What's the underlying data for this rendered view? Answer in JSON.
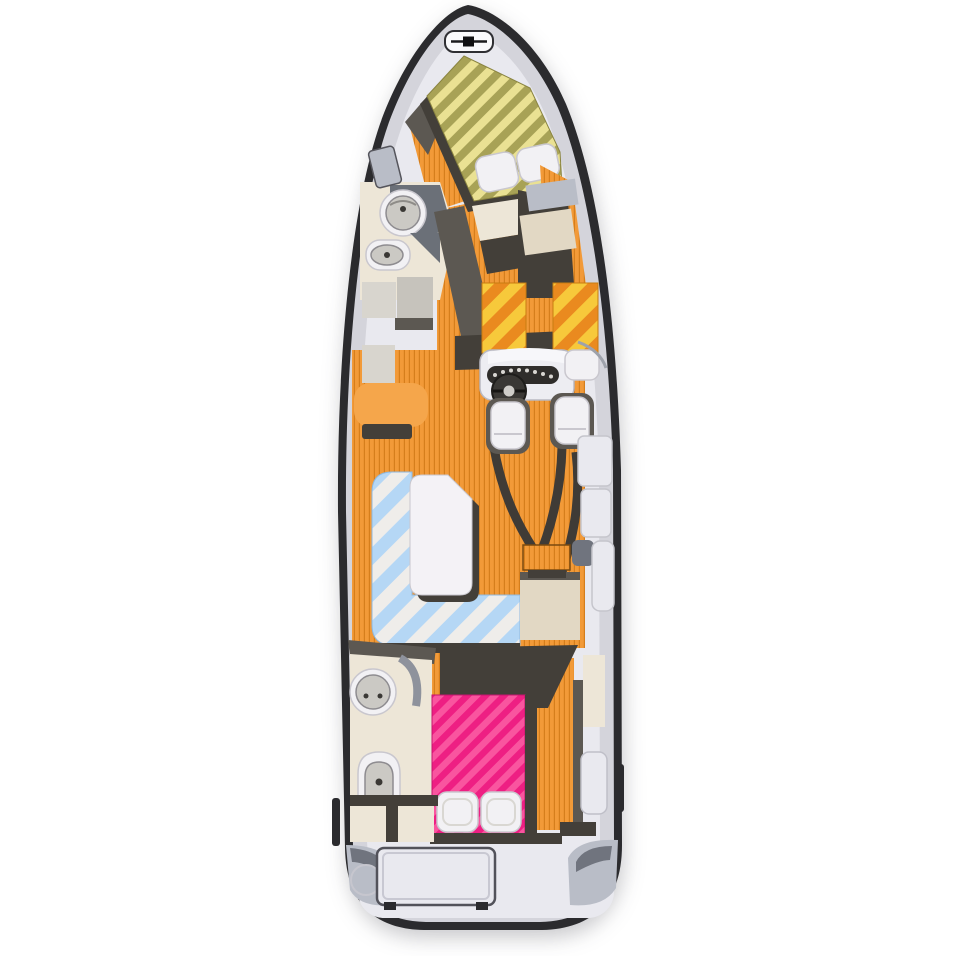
{
  "title": "motor-yacht-interior-deck-plan",
  "canvas": {
    "width": 956,
    "height": 956
  },
  "colors": {
    "page_bg": "#FFFFFF",
    "hull_outline": "#2B2B2E",
    "deck_gray": "#D4D4DB",
    "deck_light": "#E9E9EF",
    "pod_gray": "#B9BDC7",
    "pod_dark": "#70747E",
    "wall_dark": "#433F39",
    "wall_mid": "#5C5852",
    "wall_gray": "#6B7078",
    "cream": "#EDE6D7",
    "beige": "#E2D8C4",
    "stone_light": "#D8D5CE",
    "stone_mid": "#C6C3BC",
    "white_furniture": "#F2F1F4",
    "furniture_stroke": "#C9C7CE",
    "table_white": "#F4F2F6",
    "console_white": "#EDEDF2",
    "instrument_dark": "#2F2D2B",
    "wheel_dark": "#3A3835",
    "sink_gray": "#CBC9C4",
    "bench_orange": "#F5A64B",
    "floor_orange": "#F29A38",
    "floor_orange_line": "#D57E1C",
    "vberth_stripe_light": "#EAE193",
    "vberth_stripe_dark": "#A8A256",
    "pad_stripe_yellow": "#F7C93B",
    "pad_stripe_orange": "#EA8A1F",
    "dinette_stripe_white": "#EFEDEA",
    "dinette_stripe_blue": "#B5D7F5",
    "aft_bed_stripe_light": "#F9559F",
    "aft_bed_stripe_dark": "#EE1F83"
  },
  "features": {
    "bow_hatch": "anchor-locker-hatch",
    "forward_cabin_bed": "v-berth-double-bed",
    "forward_head_sink": "washbasin",
    "forward_head_toilet": "toilet",
    "galley": "galley-counters",
    "helm_console": "helm-console-with-steering-wheel",
    "helm_seats": "twin-helm-seats",
    "cockpit_seat_pads": "striped-companion-seat-cushions",
    "dinette": "l-shaped-settee-with-table",
    "companionway_steps": "steps-to-aft-cabin",
    "aft_head_sink": "washbasin",
    "aft_head_toilet": "toilet",
    "aft_cabin_bed": "double-bed-with-pillows",
    "engine_hatch": "stern-engine-hatch",
    "flooring": "plank-flooring"
  }
}
